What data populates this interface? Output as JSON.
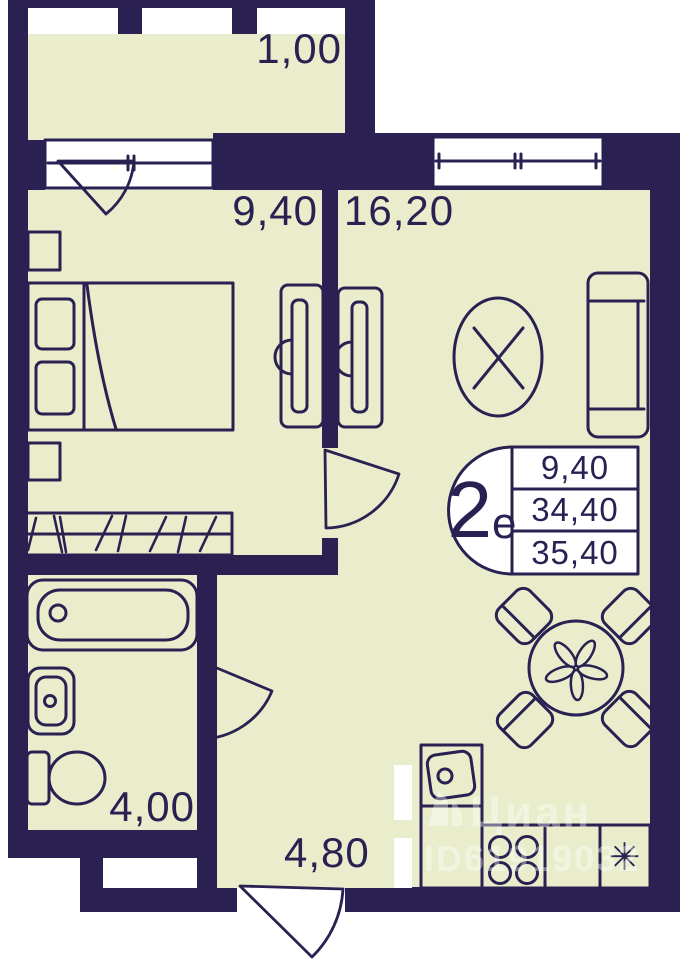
{
  "plan": {
    "colors": {
      "wall": "#2a2152",
      "room_fill": "#e9edcb",
      "line": "#2a2152",
      "background": "#ffffff"
    },
    "rooms": [
      {
        "name": "balcony",
        "area_label": "1,00"
      },
      {
        "name": "bedroom",
        "area_label": "9,40"
      },
      {
        "name": "living-kitchen",
        "area_label": "16,20"
      },
      {
        "name": "bathroom",
        "area_label": "4,00"
      },
      {
        "name": "hallway",
        "area_label": "4,80"
      }
    ],
    "stamp": {
      "apartment_type_number": "2",
      "apartment_type_letter": "е",
      "table_rows": [
        "9,40",
        "34,40",
        "35,40"
      ]
    },
    "fridge_symbol": "✳",
    "watermark": {
      "brand": "Циан",
      "id_line": "ID61919032"
    }
  }
}
